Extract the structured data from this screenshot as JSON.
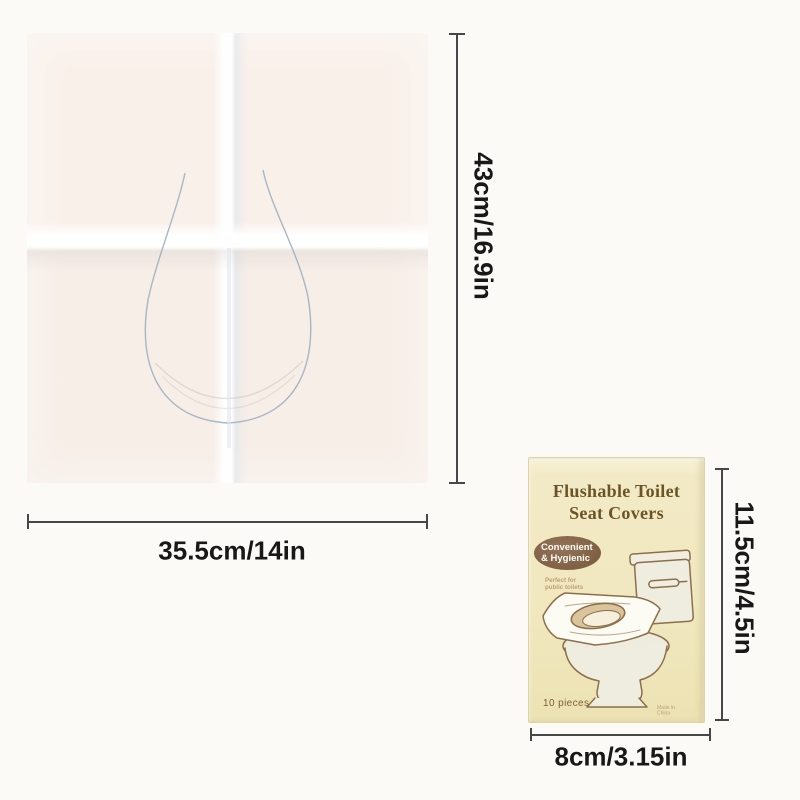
{
  "background_color": "#fcfaf6",
  "sheet": {
    "description": "unfolded disposable toilet seat cover with U-shaped cutout",
    "height_label": "43cm/16.9in",
    "width_label": "35.5cm/14in",
    "paper_color": "#f8f0ea",
    "cut_line_color": "#9fb0c0"
  },
  "package": {
    "title_line1": "Flushable Toilet",
    "title_line2": "Seat Covers",
    "badge": {
      "line1": "Convenient",
      "line2": "& Hygienic",
      "color": "#7f6043"
    },
    "tagline_line1": "Perfect for",
    "tagline_line2": "public toilets",
    "pieces_label": "10 pieces",
    "origin_label": "Made in China",
    "height_label": "11.5cm/4.5in",
    "width_label": "8cm/3.15in",
    "background_color": "#f1e8c0",
    "title_color": "#6b5526"
  },
  "dimension": {
    "line_color": "#474747",
    "text_color": "#181818"
  }
}
